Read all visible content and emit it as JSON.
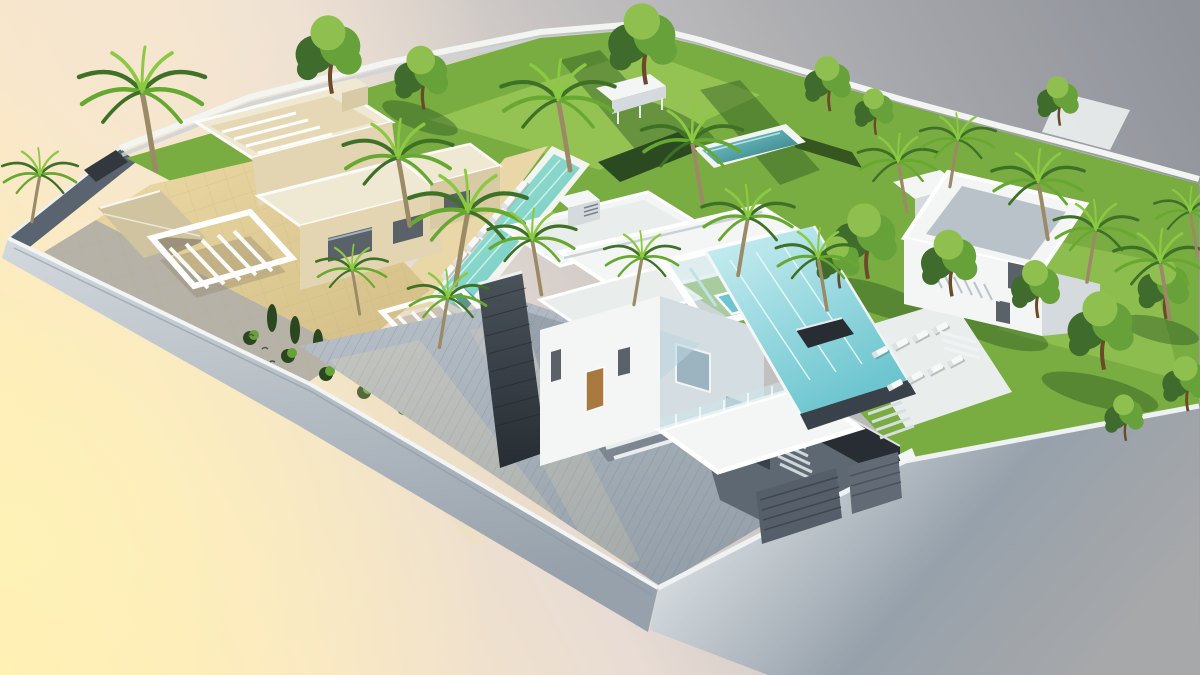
{
  "meta": {
    "type": "3d-architectural-render",
    "subject": "Aerial cutaway render of a modern luxury villa development on a floating plot",
    "villas": 3,
    "pools": 4,
    "style": "contemporary white-and-cream flat-roof villas with infinity pools, timber decks, palm trees and lawned gardens"
  },
  "scene": {
    "background": {
      "top_left": "soft peach glow",
      "bottom_left": "golden yellow glow",
      "top_right": "neutral grey",
      "bottom_right": "light grey"
    },
    "elements": [
      "boundary-wall",
      "left-villa-cream",
      "central-villa-white",
      "right-villa-white",
      "lap-pool-with-loungers",
      "infinity-pool",
      "roof-jacuzzi",
      "garden-pool",
      "timber-deck",
      "garage-court",
      "entrance-pergola",
      "terrace-pergola",
      "lawns",
      "palm-trees",
      "ficus-trees",
      "hedges",
      "sun-terrace",
      "stairs"
    ]
  },
  "counts": {
    "palm_trees": 18,
    "green_trees": 14,
    "sun_loungers": 16,
    "shrubs": 9
  },
  "palette": {
    "bg_yellow": "#ffedac",
    "bg_warm": "#f9e6c6",
    "bg_blend": "#e8dcd4",
    "bg_grey_mid": "#bfbdbe",
    "bg_grey": "#a2a4a9",
    "bg_grey_deep": "#90939a",
    "glow": "#fff3b8",
    "glow_peach": "#f9e9d2",
    "wall_rim": "#f2f5f5",
    "wall_face_light": "#d3d9dd",
    "wall_face": "#97a1ab",
    "wall_face_warm": "#a7a8aa",
    "wall_dark": "#5a6470",
    "wall_opening": "#33383e",
    "lawn": "#79ad41",
    "lawn_light": "#a6d05f",
    "lawn_shadow": "#2f5a25",
    "hedge": "#2c4a22",
    "hedge2": "#35571f",
    "pool_long_light": "#a5e6da",
    "pool_long": "#67c4ba",
    "pool_big_light": "#cdeff3",
    "pool_big": "#6cc5cf",
    "pool_deep_light": "#7ecfd2",
    "pool_deep": "#2e7680",
    "pool_rim": "#f2f4ef",
    "pool_step": "#4e9e94",
    "deck_light": "#b9c1c9",
    "deck": "#939ea8",
    "deck_shade": "#7d8892",
    "deck_beige": "#ead7a8",
    "slate_light": "#4a525a",
    "slate": "#272d33",
    "slate_mid": "#39424b",
    "court_dark": "#5e6873",
    "court_darker": "#454f59",
    "cream_roof": "#efe8d3",
    "cream_inner": "#e6d8b4",
    "cream_wall": "#e3d4b2",
    "cream_wall_dark": "#d9caa6",
    "court_light": "#ecd9a4",
    "court": "#d2bd85",
    "paver": "#b7b2a8",
    "ramp": "#cfc3a0",
    "white_lit": "#f4f6f5",
    "white_soft": "#e9eeed",
    "white_shade": "#d4dadd",
    "white_blue": "#d3dde2",
    "glass": "#9cb4c0",
    "glass_light": "#cfe6ea",
    "window_dark": "#5a6168",
    "wood_door": "#a9793f",
    "tree_dark": "#3f6b2c",
    "tree_mid": "#67a13a",
    "tree_light": "#8fc04f",
    "palm_dark": "#3e7026",
    "palm_mid": "#67a830",
    "palm_light": "#8cc943",
    "trunk": "#9b8a66",
    "tree_trunk": "#6b4a2a",
    "shrub": "#2b4720",
    "lounger": "#f7f9f8",
    "garage_panel": "#565f69",
    "garage_panel2": "#626b75"
  }
}
